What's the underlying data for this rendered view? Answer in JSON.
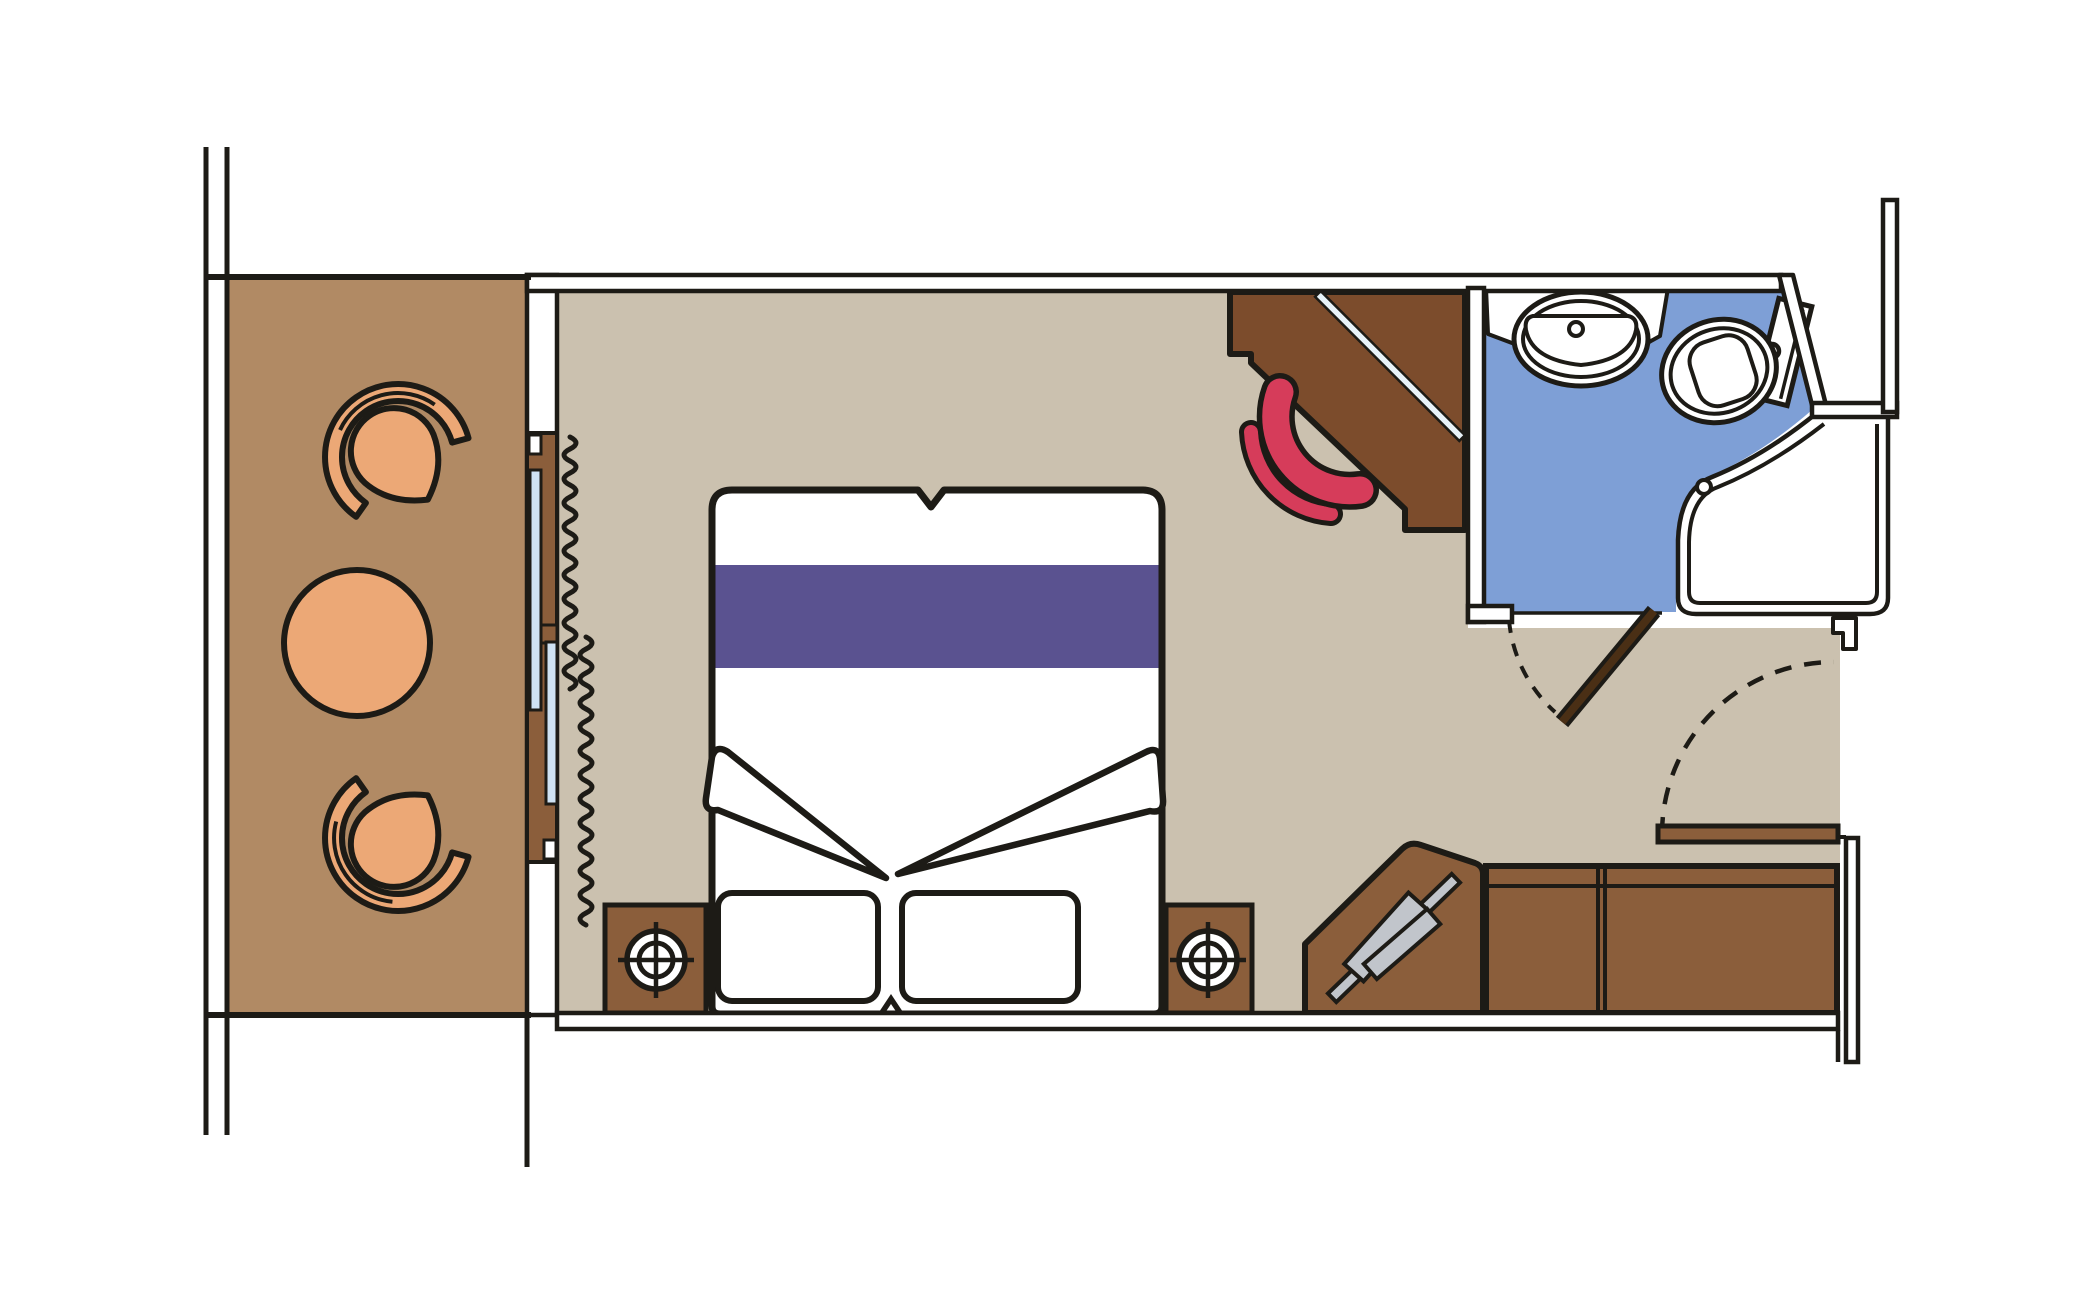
{
  "figure": {
    "type": "floor_plan",
    "subject": "cabin floor plan with balcony, bedroom area and en-suite bathroom",
    "canvas": {
      "width": 2100,
      "height": 1299
    }
  },
  "palette": {
    "line": "#1d1b16",
    "wall-fill": "#ffffff",
    "balcony-floor": "#b18a64",
    "cabin-floor": "#cbc1af",
    "bathroom-floor": "#7e9fd6",
    "furniture-wood": "#8b5e3b",
    "desk-wood": "#7c4c2c",
    "seat-orange": "#eca876",
    "duvet-purple": "#5a5290",
    "chair-red": "#d63c5a",
    "glass-blue": "#cfe2f3",
    "mirror-stripe": "#e9f3f9",
    "rail-gray": "#c1c5cb",
    "dark-door": "#4a2f15"
  },
  "balcony": {
    "furniture": [
      "tub armchair",
      "round table",
      "tub armchair"
    ],
    "chair_count": 2,
    "table_count": 1
  },
  "cabin": {
    "furniture": [
      "double bed with purple runner",
      "pillow",
      "pillow",
      "folded sheet",
      "folded sheet",
      "nightstand with lamp",
      "nightstand with lamp",
      "corner desk with mirror",
      "red desk chair",
      "corner wardrobe with clothes rail",
      "wardrobe",
      "wardrobe"
    ]
  },
  "bathroom": {
    "fixtures": [
      "oval sink on counter",
      "toilet with tank",
      "corner shower with curved glass"
    ]
  },
  "openings": {
    "balcony_slider": "sliding glass door with curtains",
    "entry_door": "hinged door with swing arc",
    "bathroom_door": "hinged door with swing arc"
  }
}
